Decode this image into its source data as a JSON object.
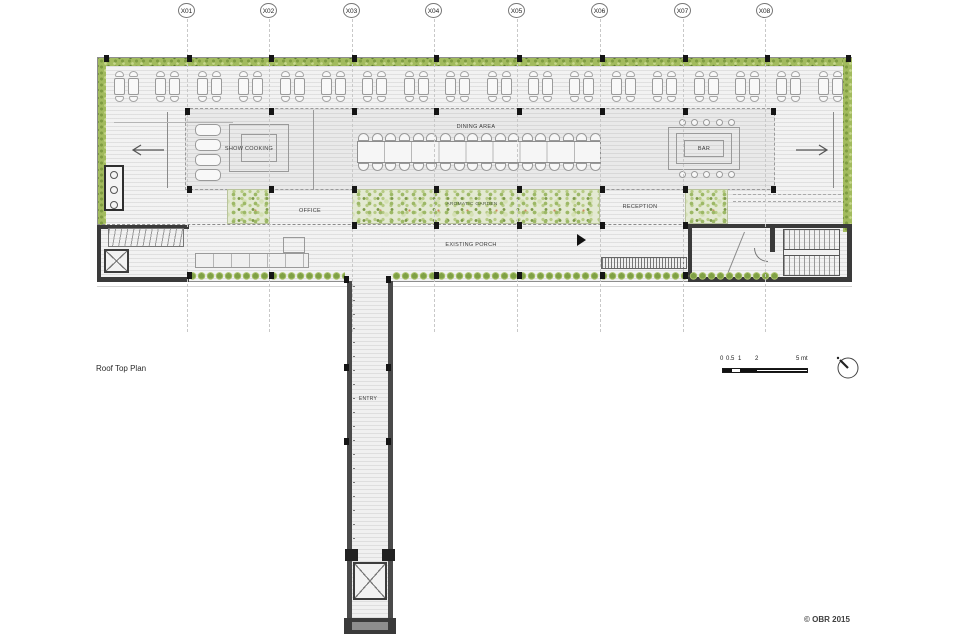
{
  "drawing": {
    "title": "Roof Top Plan",
    "copyright": "© OBR 2015"
  },
  "grid": {
    "labels": [
      "X01",
      "X02",
      "X03",
      "X04",
      "X05",
      "X06",
      "X07",
      "X08"
    ]
  },
  "plan": {
    "labels": {
      "show_cooking": "SHOW COOKING",
      "dining_area": "DINING AREA",
      "bar": "BAR",
      "office": "OFFICE",
      "aromatic_garden": "AROMATIC GARDEN",
      "reception": "RECEPTION",
      "existing_porch": "EXISTING PORCH",
      "entry": "ENTRY"
    },
    "furniture": {
      "terrace_table_clusters": 18,
      "dining_chairs_per_side": 18,
      "bar_stools_per_side": 5,
      "show_cooking_tables": 4
    },
    "colors": {
      "hedge_green": "#a2bb5e",
      "garden_base": "#e3e9d2",
      "wall_dark": "#3a3a3a",
      "marker_black": "#151515"
    },
    "icons": {
      "north": "north-arrow-icon",
      "west": "left-arrow-icon",
      "east": "right-arrow-icon",
      "porch_marker": "play-triangle-icon"
    }
  },
  "scalebar": {
    "labels": [
      "0",
      "0.5",
      "1",
      "2",
      "5 mt"
    ]
  }
}
